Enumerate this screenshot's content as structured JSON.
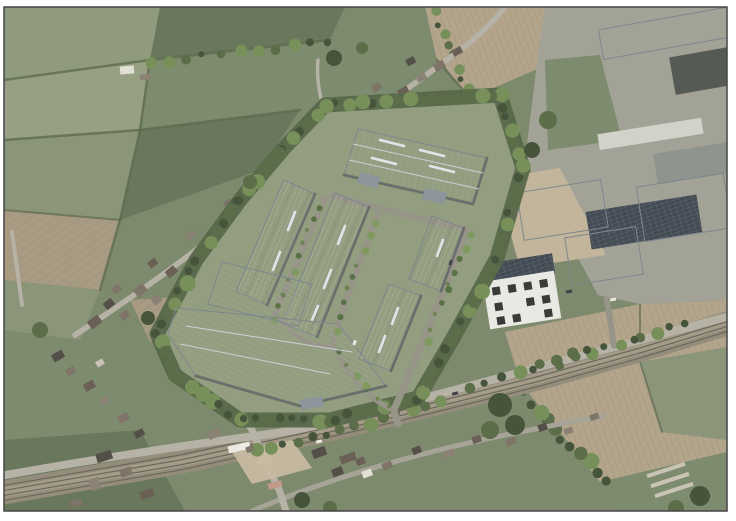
{
  "scene": {
    "type": "aerial-photomontage",
    "description": "Oblique aerial CGI photomontage of a proposed warehouse / industrial estate development: light grey pitched-roof units with a landscaped tree buffer, internal estate roads and a large terminal building, set between a village street with houses (top left), open farmland and ploughed fields, an existing industrial estate (right) and a multi-track railway line crossing the bottom of the view.",
    "regions": [
      "farmland-fields",
      "village-housing",
      "proposed-development",
      "existing-industrial-estate",
      "railway-corridor",
      "level-crossing",
      "boundary-road",
      "ploughed-fields",
      "tree-buffer",
      "office-building"
    ]
  },
  "palette": {
    "page_bg": "#ffffff",
    "photo_border": "#454545",
    "base_green": "#7e8a6d",
    "field_light": "#8f9a7e",
    "field_mid": "#7d8b6e",
    "field_dark": "#69785d",
    "field_pale": "#97a083",
    "field_bright": "#8a957a",
    "plowed_light": "#b3a58c",
    "plowed_mid": "#a89b83",
    "tree_dark": "#46543b",
    "tree_mid": "#5c6e49",
    "tree_light": "#77905a",
    "site_grass": "#939d80",
    "new_roof": "#b2bac2",
    "new_roof_dark": "#aab3bb",
    "canopy_grey": "#8d959c",
    "old_roof_light": "#d2d2cb",
    "old_roof_mid": "#b4b8b2",
    "old_roof_dark": "#565a55",
    "solar_panel": "#434b54",
    "office_white": "#e9e9e3",
    "yard_sand": "#c3b59b",
    "gravel": "#c7bba2",
    "rail_bed": "#948d7b",
    "pool_blue": "#5fb3c9"
  }
}
